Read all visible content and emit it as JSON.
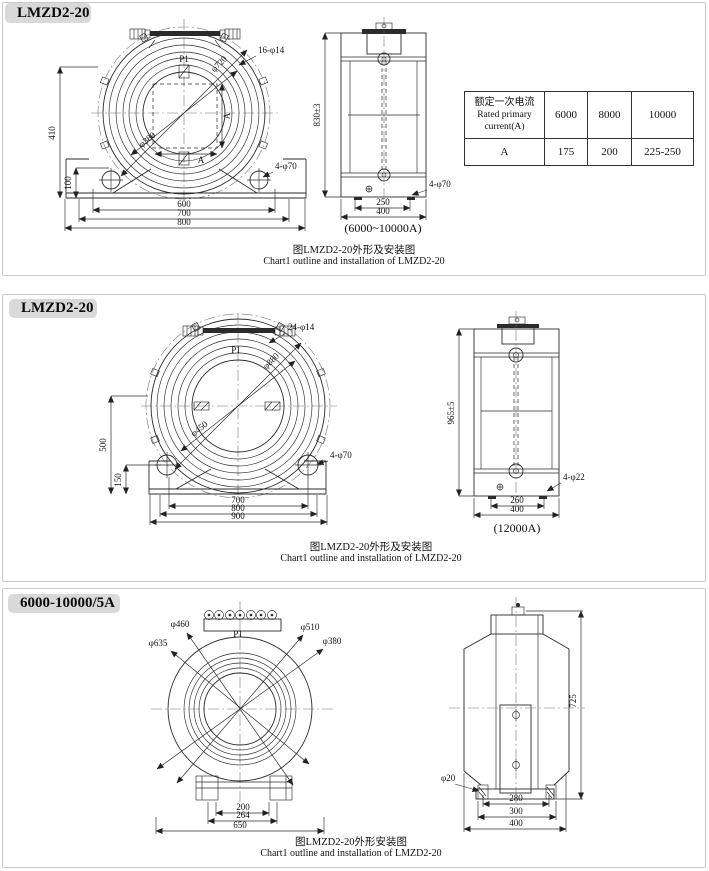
{
  "panels": [
    {
      "title": "LMZD2-20",
      "front": {
        "p1": "P1",
        "bolt_note": "16-φ14",
        "dia1": "φ720",
        "dia2": "φ380",
        "a_v": "A",
        "a_h": "A",
        "left1": "410",
        "left2": "100",
        "w1": "600",
        "w2": "700",
        "w3": "800",
        "hole_note": "4-φ70"
      },
      "side": {
        "h": "830±3",
        "w1": "250",
        "w2": "400",
        "hole_note": "4-φ70",
        "range": "(6000~10000A)"
      },
      "table": {
        "h_cn": "额定一次电流",
        "h_en1": "Rated primary",
        "h_en2": "current(A)",
        "c1": "6000",
        "c2": "8000",
        "c3": "10000",
        "row": "A",
        "v1": "175",
        "v2": "200",
        "v3": "225-250"
      },
      "cap_cn": "图LMZD2-20外形及安装图",
      "cap_en": "Chart1 outline and installation of LMZD2-20"
    },
    {
      "title": "LMZD2-20",
      "front": {
        "p1": "P1",
        "bolt_note": "24-φ14",
        "dia1": "φ880",
        "dia2": "φ450",
        "left1": "500",
        "left2": "150",
        "w1": "700",
        "w2": "800",
        "w3": "900",
        "hole_note": "4-φ70"
      },
      "side": {
        "h": "965±5",
        "w1": "260",
        "w2": "400",
        "hole_note": "4-φ22",
        "range": "(12000A)"
      },
      "cap_cn": "图LMZD2-20外形及安装图",
      "cap_en": "Chart1 outline and installation of LMZD2-20"
    },
    {
      "title": "6000-10000/5A",
      "front": {
        "p1": "P1",
        "dia1": "φ635",
        "dia2": "φ460",
        "dia3": "φ510",
        "dia4": "φ380",
        "w1": "200",
        "w2": "264",
        "w3": "650"
      },
      "side": {
        "h": "725",
        "hole_note": "φ20",
        "w1": "280",
        "w2": "300",
        "w3": "400"
      },
      "cap_cn": "图LMZD2-20外形安装图",
      "cap_en": "Chart1 outline and installation of LMZD2-20"
    }
  ]
}
